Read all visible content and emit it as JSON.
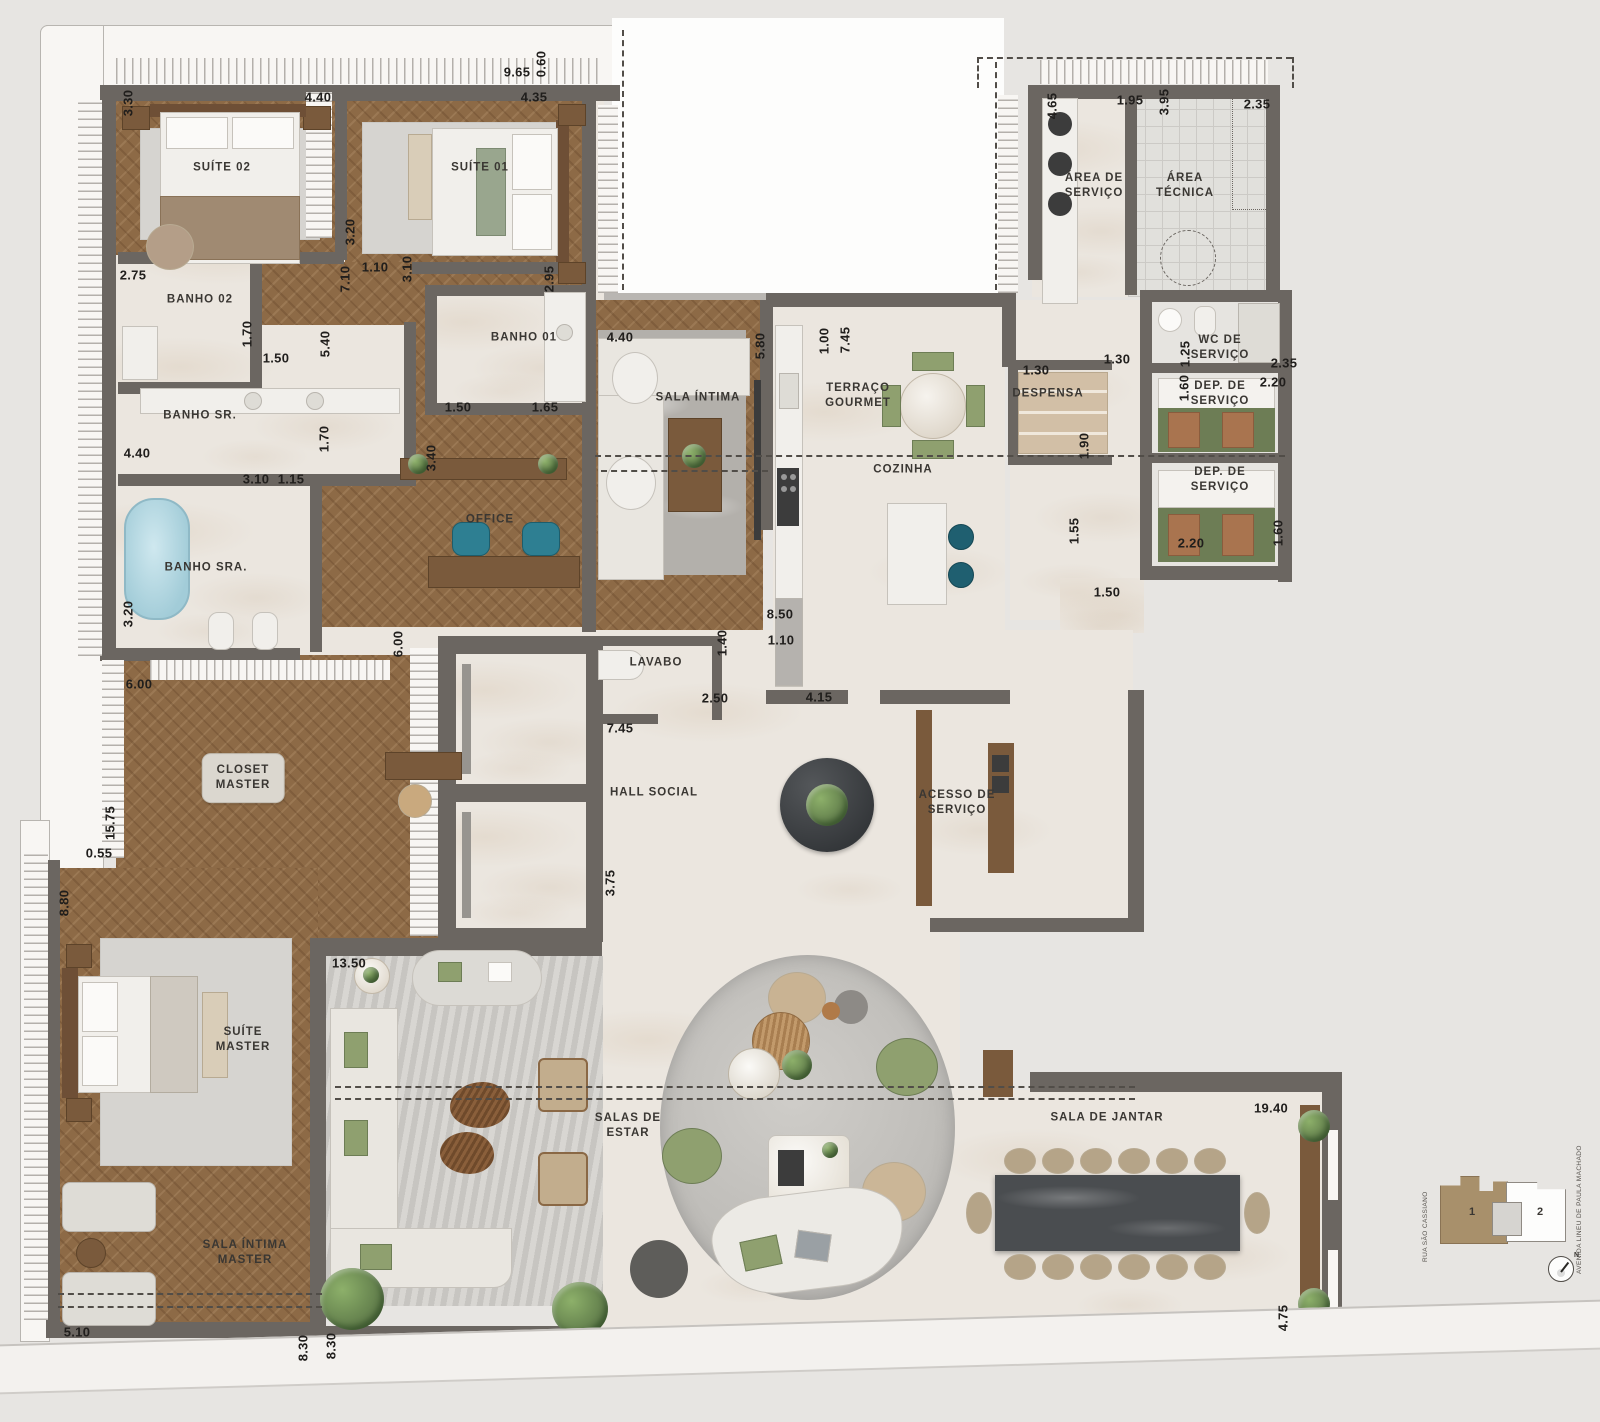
{
  "rooms": [
    {
      "label": "SUÍTE 02",
      "x": 222,
      "y": 168
    },
    {
      "label": "SUÍTE 01",
      "x": 480,
      "y": 168
    },
    {
      "label": "BANHO 02",
      "x": 200,
      "y": 300
    },
    {
      "label": "BANHO SR.",
      "x": 200,
      "y": 416
    },
    {
      "label": "BANHO SRA.",
      "x": 206,
      "y": 568
    },
    {
      "label": "BANHO 01",
      "x": 524,
      "y": 338
    },
    {
      "label": "OFFICE",
      "x": 490,
      "y": 520
    },
    {
      "label": "SALA ÍNTIMA",
      "x": 698,
      "y": 398
    },
    {
      "label": "TERRAÇO\nGOURMET",
      "x": 858,
      "y": 396
    },
    {
      "label": "COZINHA",
      "x": 903,
      "y": 470
    },
    {
      "label": "DESPENSA",
      "x": 1048,
      "y": 394
    },
    {
      "label": "ÁREA DE\nSERVIÇO",
      "x": 1094,
      "y": 186
    },
    {
      "label": "ÁREA\nTÉCNICA",
      "x": 1185,
      "y": 186
    },
    {
      "label": "WC DE\nSERVIÇO",
      "x": 1220,
      "y": 348
    },
    {
      "label": "DEP. DE\nSERVIÇO",
      "x": 1220,
      "y": 394
    },
    {
      "label": "DEP. DE\nSERVIÇO",
      "x": 1220,
      "y": 480
    },
    {
      "label": "LAVABO",
      "x": 656,
      "y": 663
    },
    {
      "label": "HALL SOCIAL",
      "x": 654,
      "y": 793
    },
    {
      "label": "ACESSO DE\nSERVIÇO",
      "x": 957,
      "y": 803
    },
    {
      "label": "CLOSET\nMASTER",
      "x": 243,
      "y": 778,
      "badge": true
    },
    {
      "label": "SUÍTE\nMASTER",
      "x": 243,
      "y": 1040
    },
    {
      "label": "SALA ÍNTIMA\nMASTER",
      "x": 245,
      "y": 1253
    },
    {
      "label": "SALAS DE\nESTAR",
      "x": 628,
      "y": 1126
    },
    {
      "label": "SALA DE JANTAR",
      "x": 1107,
      "y": 1118
    }
  ],
  "dimensions": [
    {
      "t": "9.65",
      "x": 517,
      "y": 72
    },
    {
      "t": "0.60",
      "x": 541,
      "y": 64,
      "v": 1
    },
    {
      "t": "3.30",
      "x": 128,
      "y": 103,
      "v": 1
    },
    {
      "t": "4.40",
      "x": 318,
      "y": 97
    },
    {
      "t": "4.35",
      "x": 534,
      "y": 97
    },
    {
      "t": "3.20",
      "x": 350,
      "y": 232,
      "v": 1
    },
    {
      "t": "2.75",
      "x": 133,
      "y": 275
    },
    {
      "t": "7.10",
      "x": 345,
      "y": 279,
      "v": 1
    },
    {
      "t": "1.10",
      "x": 375,
      "y": 267
    },
    {
      "t": "3.10",
      "x": 407,
      "y": 269,
      "v": 1
    },
    {
      "t": "2.95",
      "x": 549,
      "y": 279,
      "v": 1
    },
    {
      "t": "1.70",
      "x": 247,
      "y": 334,
      "v": 1
    },
    {
      "t": "1.50",
      "x": 276,
      "y": 358
    },
    {
      "t": "5.40",
      "x": 325,
      "y": 344,
      "v": 1
    },
    {
      "t": "1.50",
      "x": 458,
      "y": 407
    },
    {
      "t": "1.65",
      "x": 545,
      "y": 407
    },
    {
      "t": "4.40",
      "x": 137,
      "y": 453
    },
    {
      "t": "1.70",
      "x": 324,
      "y": 439,
      "v": 1
    },
    {
      "t": "3.10",
      "x": 256,
      "y": 479
    },
    {
      "t": "1.15",
      "x": 291,
      "y": 479
    },
    {
      "t": "3.40",
      "x": 431,
      "y": 458,
      "v": 1
    },
    {
      "t": "3.20",
      "x": 128,
      "y": 614,
      "v": 1
    },
    {
      "t": "6.00",
      "x": 398,
      "y": 644,
      "v": 1
    },
    {
      "t": "4.40",
      "x": 620,
      "y": 337
    },
    {
      "t": "5.80",
      "x": 760,
      "y": 346,
      "v": 1
    },
    {
      "t": "1.00",
      "x": 824,
      "y": 341,
      "v": 1
    },
    {
      "t": "7.45",
      "x": 845,
      "y": 340,
      "v": 1
    },
    {
      "t": "8.50",
      "x": 780,
      "y": 614
    },
    {
      "t": "1.40",
      "x": 722,
      "y": 643,
      "v": 1
    },
    {
      "t": "1.10",
      "x": 781,
      "y": 640
    },
    {
      "t": "1.30",
      "x": 1036,
      "y": 370
    },
    {
      "t": "1.90",
      "x": 1084,
      "y": 446,
      "v": 1
    },
    {
      "t": "1.30",
      "x": 1117,
      "y": 359
    },
    {
      "t": "1.25",
      "x": 1185,
      "y": 354,
      "v": 1
    },
    {
      "t": "2.35",
      "x": 1284,
      "y": 363
    },
    {
      "t": "1.60",
      "x": 1184,
      "y": 388,
      "v": 1
    },
    {
      "t": "2.20",
      "x": 1273,
      "y": 382
    },
    {
      "t": "2.20",
      "x": 1191,
      "y": 543
    },
    {
      "t": "1.60",
      "x": 1278,
      "y": 533,
      "v": 1
    },
    {
      "t": "1.55",
      "x": 1074,
      "y": 531,
      "v": 1
    },
    {
      "t": "1.50",
      "x": 1107,
      "y": 592
    },
    {
      "t": "4.65",
      "x": 1052,
      "y": 106,
      "v": 1
    },
    {
      "t": "1.95",
      "x": 1130,
      "y": 100
    },
    {
      "t": "3.95",
      "x": 1164,
      "y": 102,
      "v": 1
    },
    {
      "t": "2.35",
      "x": 1257,
      "y": 104
    },
    {
      "t": "7.45",
      "x": 620,
      "y": 728
    },
    {
      "t": "3.75",
      "x": 610,
      "y": 883,
      "v": 1
    },
    {
      "t": "2.50",
      "x": 715,
      "y": 698
    },
    {
      "t": "4.15",
      "x": 819,
      "y": 697
    },
    {
      "t": "6.00",
      "x": 139,
      "y": 684
    },
    {
      "t": "15.75",
      "x": 110,
      "y": 823,
      "v": 1
    },
    {
      "t": "0.55",
      "x": 99,
      "y": 853
    },
    {
      "t": "8.80",
      "x": 64,
      "y": 903,
      "v": 1
    },
    {
      "t": "13.50",
      "x": 349,
      "y": 963
    },
    {
      "t": "5.10",
      "x": 77,
      "y": 1332
    },
    {
      "t": "8.30",
      "x": 303,
      "y": 1348,
      "v": 1
    },
    {
      "t": "8.30",
      "x": 331,
      "y": 1346,
      "v": 1
    },
    {
      "t": "19.40",
      "x": 1271,
      "y": 1108
    },
    {
      "t": "4.75",
      "x": 1283,
      "y": 1318,
      "v": 1
    }
  ],
  "keyplan": {
    "street_left": "RUA SÃO CASSIANO",
    "street_right": "AVENIDA  LINEU DE PAULA MACHADO",
    "unit_1": "1",
    "unit_2": "2",
    "north": "N"
  },
  "colors": {
    "wall": "#6b6661",
    "wood_floor": "#8d6a46",
    "marble_floor": "#ebe6df",
    "terrace_band": "#f8f6f3",
    "rug": "#d6d4d0",
    "accent_teal": "#2e7f92",
    "accent_green": "#8fa06f",
    "dark_stone": "#3e4144",
    "keyplan_unit1": "#a8906b",
    "background": "#e7e5e2"
  }
}
